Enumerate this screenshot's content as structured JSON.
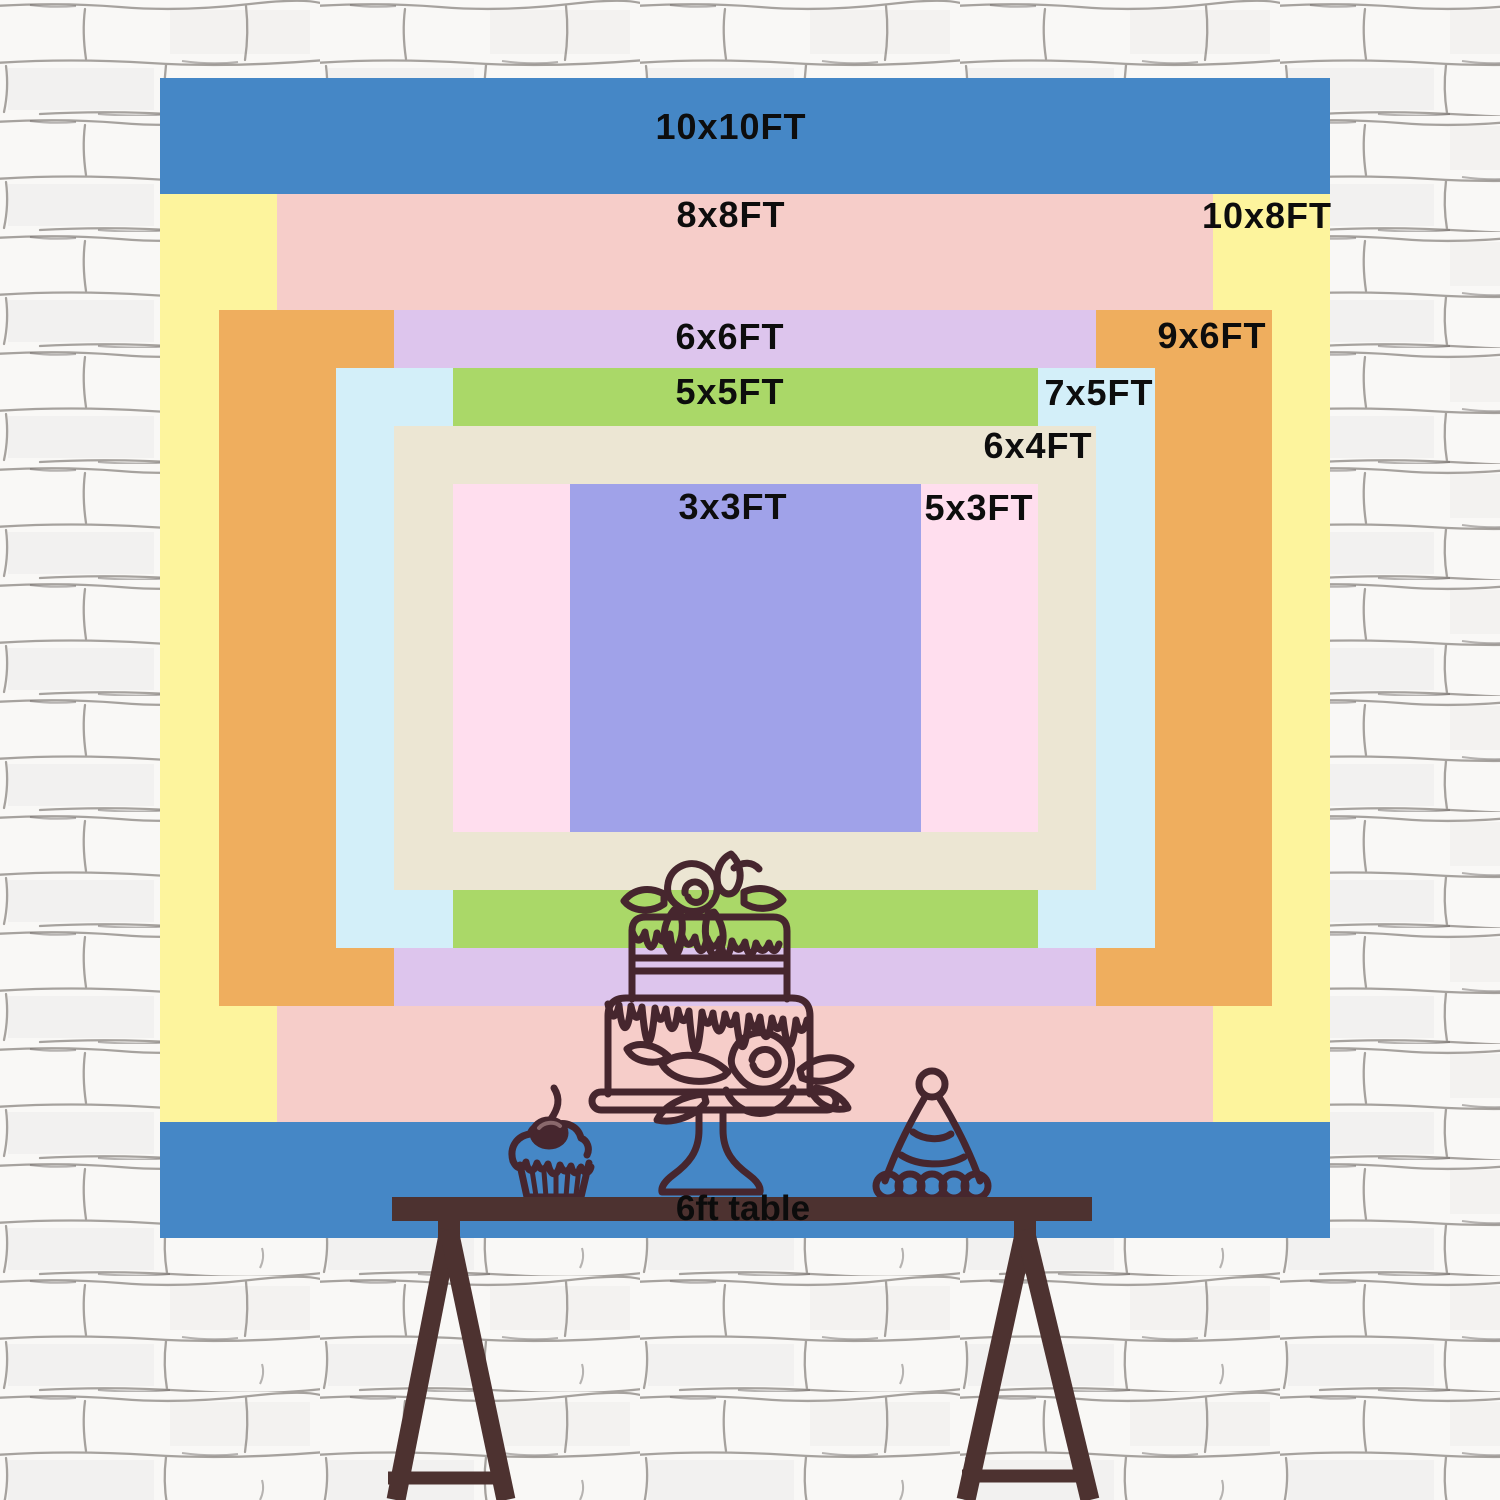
{
  "meta": {
    "title": "Backdrop size comparison chart"
  },
  "banner": {
    "px_per_ft_x": 117,
    "px_per_ft_y": 116,
    "label_color": "#0d0d0d",
    "sizes": [
      {
        "id": "10x10",
        "label": "10x10FT",
        "w_ft": 10,
        "h_ft": 10,
        "color": "#4587c6",
        "label_x": 571,
        "label_y": 49
      },
      {
        "id": "10x8",
        "label": "10x8FT",
        "w_ft": 10,
        "h_ft": 8,
        "color": "#fdf49d",
        "label_x": 1107,
        "label_y": 138
      },
      {
        "id": "8x8",
        "label": "8x8FT",
        "w_ft": 8,
        "h_ft": 8,
        "color": "#f6cdc9",
        "label_x": 571,
        "label_y": 137
      },
      {
        "id": "9x6",
        "label": "9x6FT",
        "w_ft": 9,
        "h_ft": 6,
        "color": "#efae5e",
        "label_x": 1052,
        "label_y": 258
      },
      {
        "id": "6x6",
        "label": "6x6FT",
        "w_ft": 6,
        "h_ft": 6,
        "color": "#ddc5ed",
        "label_x": 570,
        "label_y": 259
      },
      {
        "id": "7x5",
        "label": "7x5FT",
        "w_ft": 7,
        "h_ft": 5,
        "color": "#d3eff9",
        "label_x": 939,
        "label_y": 315
      },
      {
        "id": "5x5",
        "label": "5x5FT",
        "w_ft": 5,
        "h_ft": 5,
        "color": "#aad868",
        "label_x": 570,
        "label_y": 314
      },
      {
        "id": "6x4",
        "label": "6x4FT",
        "w_ft": 6,
        "h_ft": 4,
        "color": "#ece6d3",
        "label_x": 878,
        "label_y": 368
      },
      {
        "id": "5x3",
        "label": "5x3FT",
        "w_ft": 5,
        "h_ft": 3,
        "color": "#ffdeee",
        "label_x": 819,
        "label_y": 430
      },
      {
        "id": "3x3",
        "label": "3x3FT",
        "w_ft": 3,
        "h_ft": 3,
        "color": "#a0a2e9",
        "label_x": 573,
        "label_y": 429
      }
    ]
  },
  "table": {
    "label": "6ft table",
    "color": "#4d3230"
  },
  "decor": {
    "line_color": "#46262e",
    "cherry_highlight": "#8a686c",
    "items": [
      "rose-drip-cake",
      "cherry-cupcake",
      "party-hat"
    ]
  },
  "wall": {
    "base": "#f9f8f6",
    "line": "#6b645e"
  }
}
